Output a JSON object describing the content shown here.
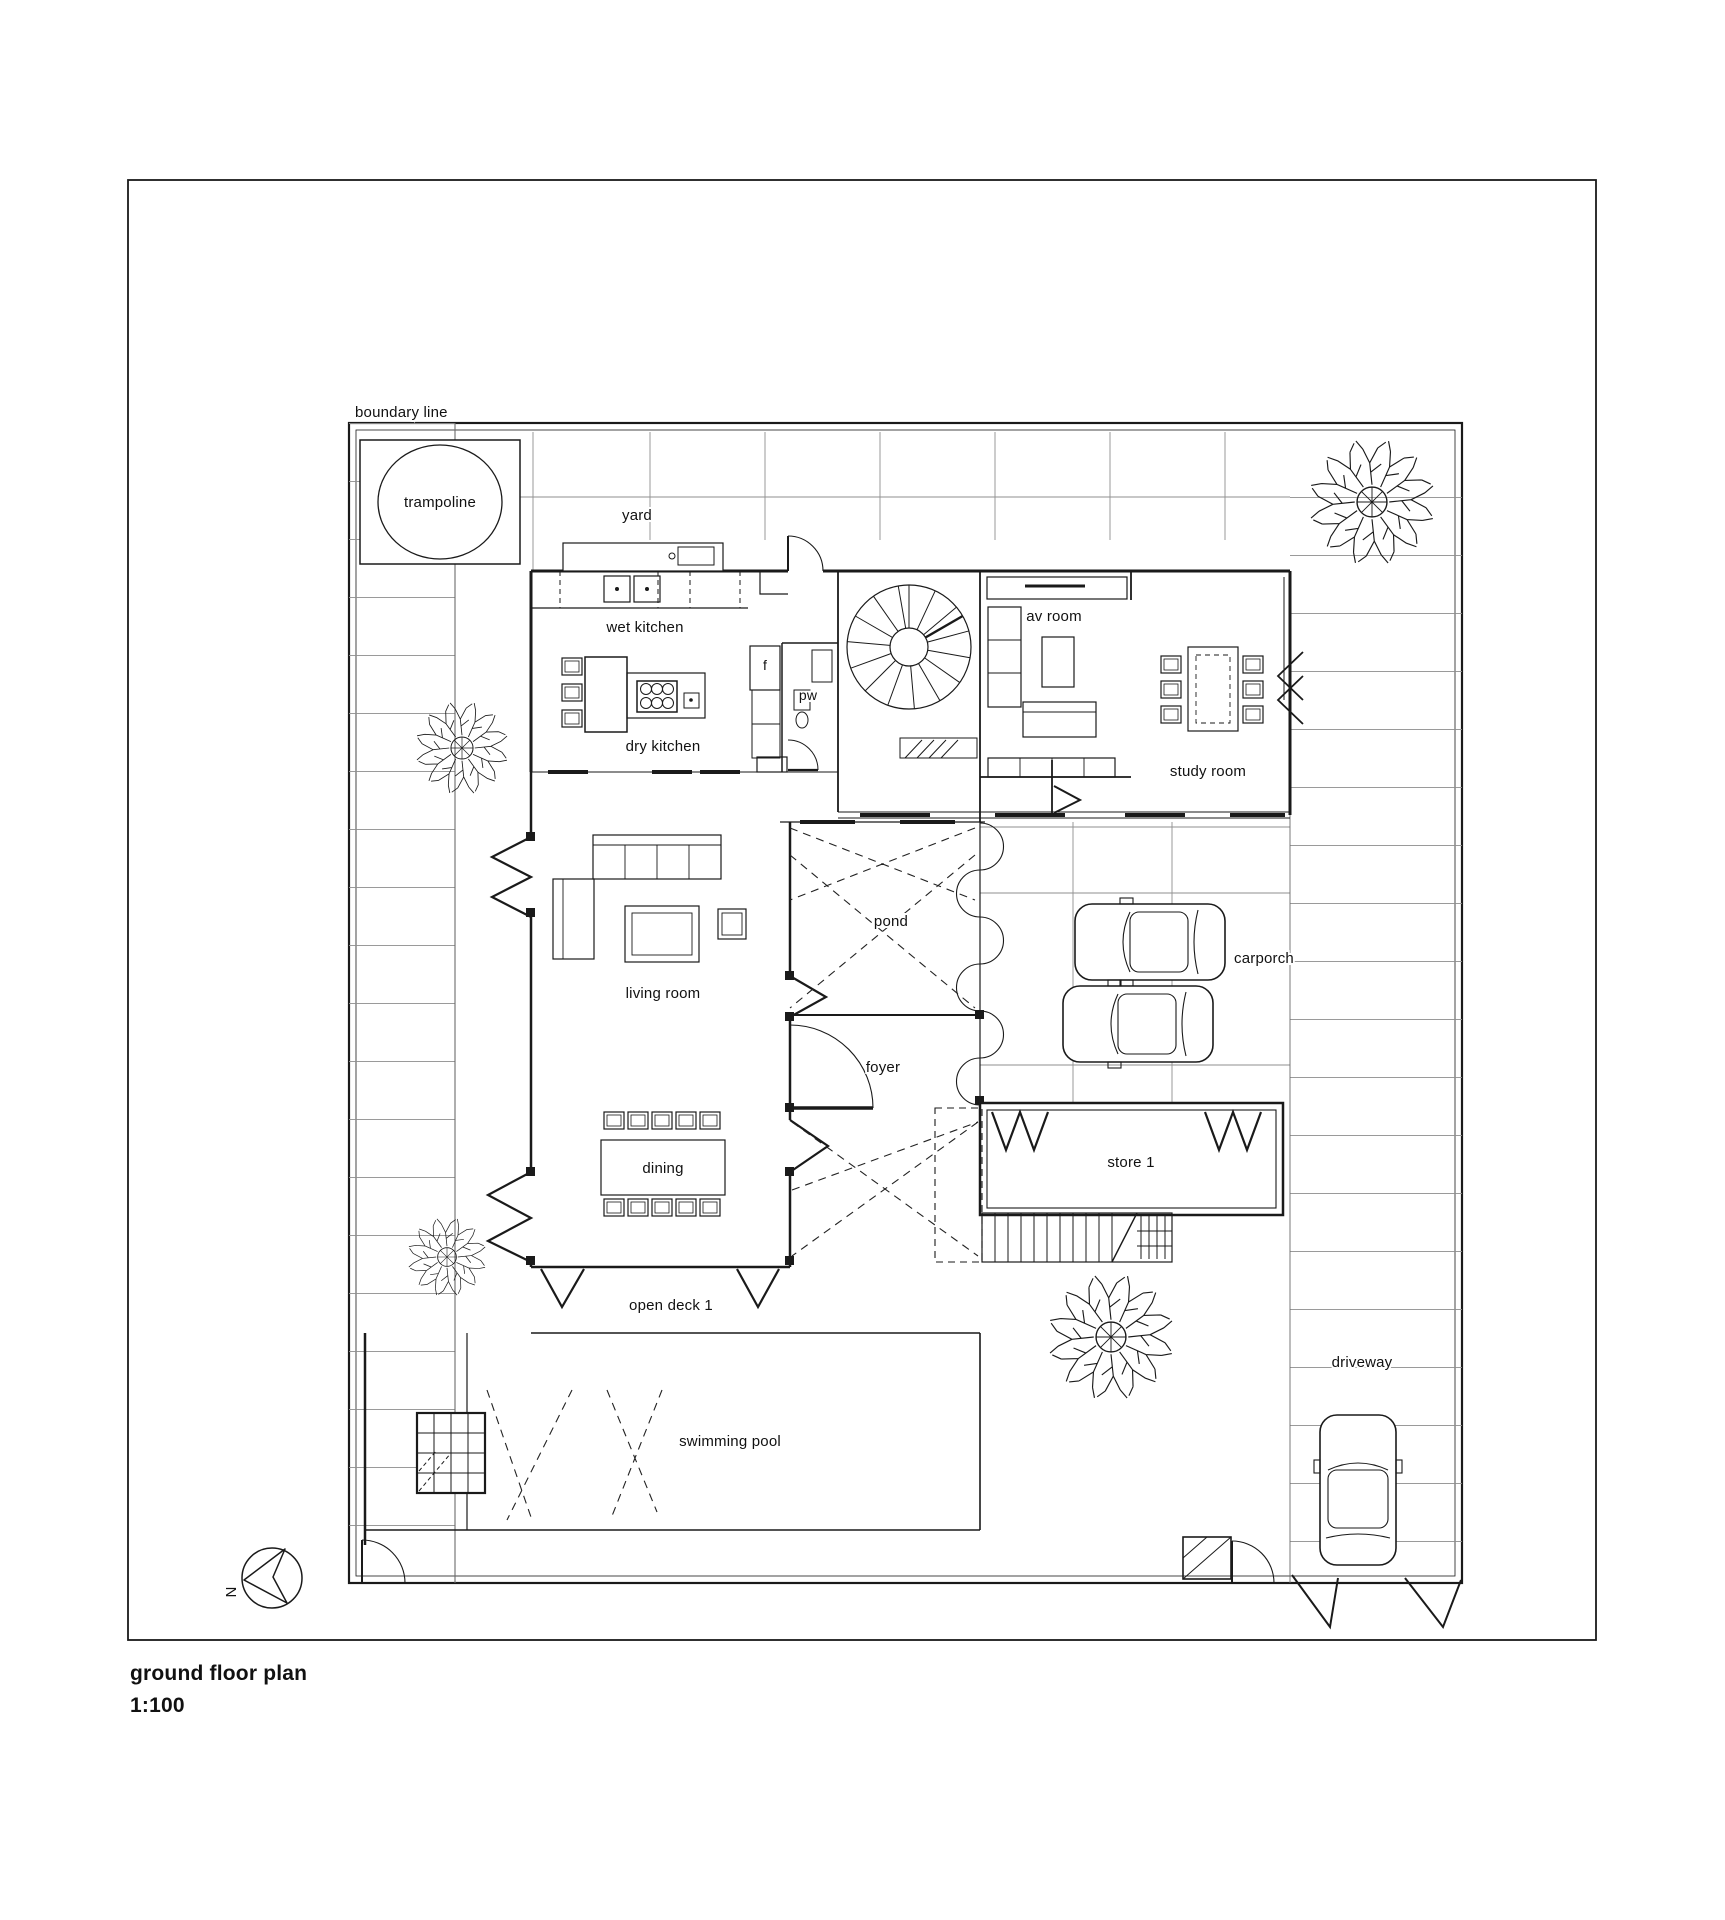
{
  "title": {
    "name": "ground floor plan",
    "scale": "1:100"
  },
  "labels": {
    "boundary": "boundary line",
    "trampoline": "trampoline",
    "yard": "yard",
    "wet_kitchen": "wet kitchen",
    "dry_kitchen": "dry kitchen",
    "fridge": "f",
    "powder": "pw",
    "av_room": "av room",
    "study_room": "study room",
    "living_room": "living room",
    "pond": "pond",
    "foyer": "foyer",
    "carporch": "carporch",
    "store": "store 1",
    "dining": "dining",
    "open_deck": "open deck 1",
    "swimming_pool": "swimming pool",
    "driveway": "driveway",
    "north": "N"
  },
  "colors": {
    "line": "#1a1a1a",
    "paving": "#8f8f8f",
    "background": "#ffffff"
  }
}
